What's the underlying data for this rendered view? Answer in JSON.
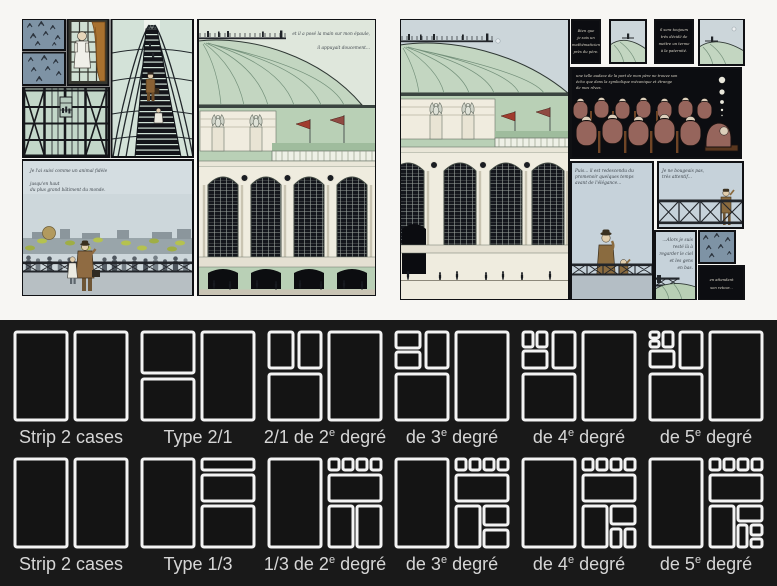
{
  "palette": {
    "paper_bg": "#f7f6f3",
    "panel_border": "#101114",
    "sky_blue": "#ccd6da",
    "dome_green": "#c3d6c1",
    "facade_green": "#b9d0b6",
    "facade_cream": "#efecdf",
    "glass_green": "#c3d7c9",
    "bird_panel_blue": "#7e93a5",
    "coat_brown": "#8a6b3f",
    "audience_maroon": "#96655c",
    "diagram_bg": "#191919",
    "diagram_stroke": "#f3f3f3",
    "label_grey": "#d6d6d6"
  },
  "comic": {
    "left_page": {
      "captions": {
        "dome": [
          "et il a posé la main sur mon épaule,",
          "il appuyait doucement..."
        ],
        "balcony": [
          "Je l'ai suivi comme un animal fidèle",
          "jusqu'en haut",
          "du plus grand bâtiment du monde."
        ]
      }
    },
    "right_page": {
      "captions": {
        "box1": [
          "Bien que",
          "je sois un",
          "mathématicien",
          "près du père."
        ],
        "box2": [
          "il sera toujours",
          "très décidé de",
          "mettre un terme",
          "à la paternité."
        ],
        "audience": [
          "une telle audace de la part de mon père ne trouve son",
          "écho que dans la symbolique mécanique et étrange",
          "de mes rêves."
        ],
        "man_child": [
          "Puis... il est redescendu du",
          "promenoir quelques temps",
          "avant de l'élégance..."
        ],
        "x_rail": [
          "Je ne bougeais pas,",
          "très attentif..."
        ],
        "balcony_right": [
          "...Alors je suis",
          "resté là à",
          "regarder le ciel",
          "et les gens",
          "en bas."
        ],
        "waiting": [
          "en attendant",
          "son retour..."
        ]
      }
    }
  },
  "layout_rows": [
    {
      "name": "strip-2-1",
      "items": [
        {
          "label": {
            "pre": "Strip 2 cases",
            "sup": "",
            "post": ""
          },
          "rects": [
            [
              0,
              0,
              52,
              88
            ],
            [
              60,
              0,
              52,
              88
            ]
          ]
        },
        {
          "label": {
            "pre": "Type 2/1",
            "sup": "",
            "post": ""
          },
          "rects": [
            [
              0,
              0,
              52,
              41
            ],
            [
              0,
              47,
              52,
              41
            ],
            [
              60,
              0,
              52,
              88
            ]
          ]
        },
        {
          "label": {
            "pre": "2/1 de 2",
            "sup": "e",
            "post": " degré"
          },
          "rects": [
            [
              0,
              0,
              24,
              36
            ],
            [
              30,
              0,
              22,
              36
            ],
            [
              0,
              42,
              52,
              46
            ],
            [
              60,
              0,
              52,
              88
            ]
          ]
        },
        {
          "label": {
            "pre": "de 3",
            "sup": "e",
            "post": " degré"
          },
          "rects": [
            [
              0,
              0,
              24,
              16
            ],
            [
              0,
              20,
              24,
              16
            ],
            [
              30,
              0,
              22,
              36
            ],
            [
              0,
              42,
              52,
              46
            ],
            [
              60,
              0,
              52,
              88
            ]
          ]
        },
        {
          "label": {
            "pre": "de 4",
            "sup": "e",
            "post": " degré"
          },
          "rects": [
            [
              0,
              0,
              10,
              15
            ],
            [
              14,
              0,
              10,
              15
            ],
            [
              0,
              19,
              24,
              17
            ],
            [
              30,
              0,
              22,
              36
            ],
            [
              0,
              42,
              52,
              46
            ],
            [
              60,
              0,
              52,
              88
            ]
          ]
        },
        {
          "label": {
            "pre": "de 5",
            "sup": "e",
            "post": " degré"
          },
          "rects": [
            [
              0,
              0,
              9,
              6
            ],
            [
              0,
              9,
              9,
              6
            ],
            [
              13,
              0,
              10,
              15
            ],
            [
              0,
              19,
              24,
              16
            ],
            [
              30,
              0,
              22,
              36
            ],
            [
              0,
              42,
              52,
              46
            ],
            [
              60,
              0,
              52,
              88
            ]
          ]
        }
      ]
    },
    {
      "name": "strip-1-3",
      "items": [
        {
          "label": {
            "pre": "Strip 2 cases",
            "sup": "",
            "post": ""
          },
          "rects": [
            [
              0,
              0,
              52,
              88
            ],
            [
              60,
              0,
              52,
              88
            ]
          ]
        },
        {
          "label": {
            "pre": "Type 1/3",
            "sup": "",
            "post": ""
          },
          "rects": [
            [
              0,
              0,
              52,
              88
            ],
            [
              60,
              0,
              52,
              11
            ],
            [
              60,
              16,
              52,
              26
            ],
            [
              60,
              47,
              52,
              41
            ]
          ]
        },
        {
          "label": {
            "pre": "1/3 de 2",
            "sup": "e",
            "post": " degré"
          },
          "rects": [
            [
              0,
              0,
              52,
              88
            ],
            [
              60,
              0,
              10,
              11
            ],
            [
              74,
              0,
              10,
              11
            ],
            [
              88,
              0,
              10,
              11
            ],
            [
              102,
              0,
              10,
              11
            ],
            [
              60,
              16,
              52,
              26
            ],
            [
              60,
              47,
              24,
              41
            ],
            [
              88,
              47,
              24,
              41
            ]
          ]
        },
        {
          "label": {
            "pre": "de 3",
            "sup": "e",
            "post": " degré"
          },
          "rects": [
            [
              0,
              0,
              52,
              88
            ],
            [
              60,
              0,
              10,
              11
            ],
            [
              74,
              0,
              10,
              11
            ],
            [
              88,
              0,
              10,
              11
            ],
            [
              102,
              0,
              10,
              11
            ],
            [
              60,
              16,
              52,
              26
            ],
            [
              60,
              47,
              24,
              41
            ],
            [
              88,
              47,
              24,
              19
            ],
            [
              88,
              71,
              24,
              17
            ]
          ]
        },
        {
          "label": {
            "pre": "de 4",
            "sup": "e",
            "post": " degré"
          },
          "rects": [
            [
              0,
              0,
              52,
              88
            ],
            [
              60,
              0,
              10,
              11
            ],
            [
              74,
              0,
              10,
              11
            ],
            [
              88,
              0,
              10,
              11
            ],
            [
              102,
              0,
              10,
              11
            ],
            [
              60,
              16,
              52,
              26
            ],
            [
              60,
              47,
              24,
              41
            ],
            [
              88,
              47,
              24,
              18
            ],
            [
              88,
              70,
              10,
              18
            ],
            [
              102,
              70,
              10,
              18
            ]
          ]
        },
        {
          "label": {
            "pre": "de 5",
            "sup": "e",
            "post": " degré"
          },
          "rects": [
            [
              0,
              0,
              52,
              88
            ],
            [
              60,
              0,
              10,
              11
            ],
            [
              74,
              0,
              10,
              11
            ],
            [
              88,
              0,
              10,
              11
            ],
            [
              102,
              0,
              10,
              11
            ],
            [
              60,
              16,
              52,
              26
            ],
            [
              60,
              47,
              24,
              41
            ],
            [
              88,
              47,
              24,
              15
            ],
            [
              88,
              66,
              9,
              22
            ],
            [
              101,
              66,
              11,
              10
            ],
            [
              101,
              80,
              11,
              8
            ]
          ]
        }
      ]
    }
  ]
}
